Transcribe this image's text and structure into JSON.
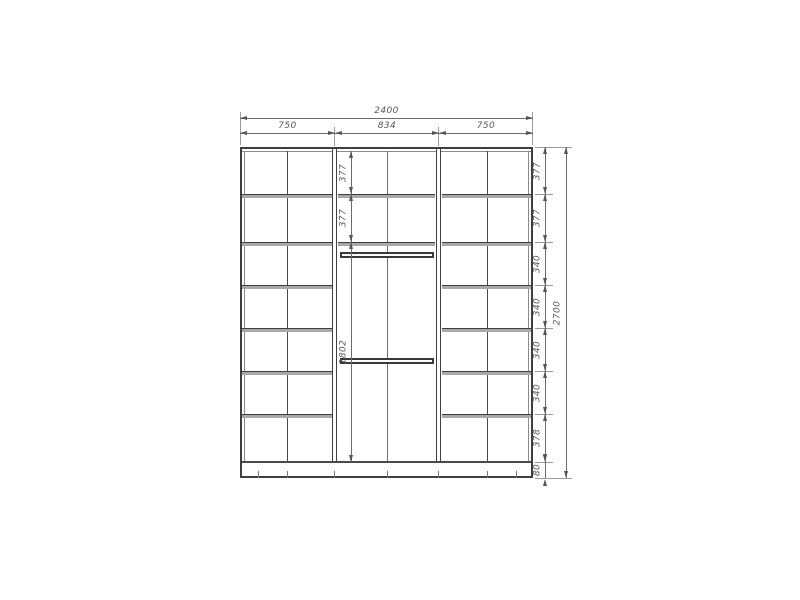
{
  "drawing": {
    "type": "wardrobe-front-elevation-dimensions",
    "line_color": "#3f3f3f",
    "dim_color": "#585858",
    "background": "#ffffff"
  },
  "dims": {
    "total_width": "2400",
    "section_widths": [
      "750",
      "834",
      "750"
    ],
    "row_heights": [
      "377",
      "377",
      "340",
      "340",
      "340",
      "340",
      "378"
    ],
    "plinth_height": "80",
    "total_height": "2700",
    "center_rows": [
      "377",
      "377"
    ],
    "hanging_height": "1802"
  }
}
